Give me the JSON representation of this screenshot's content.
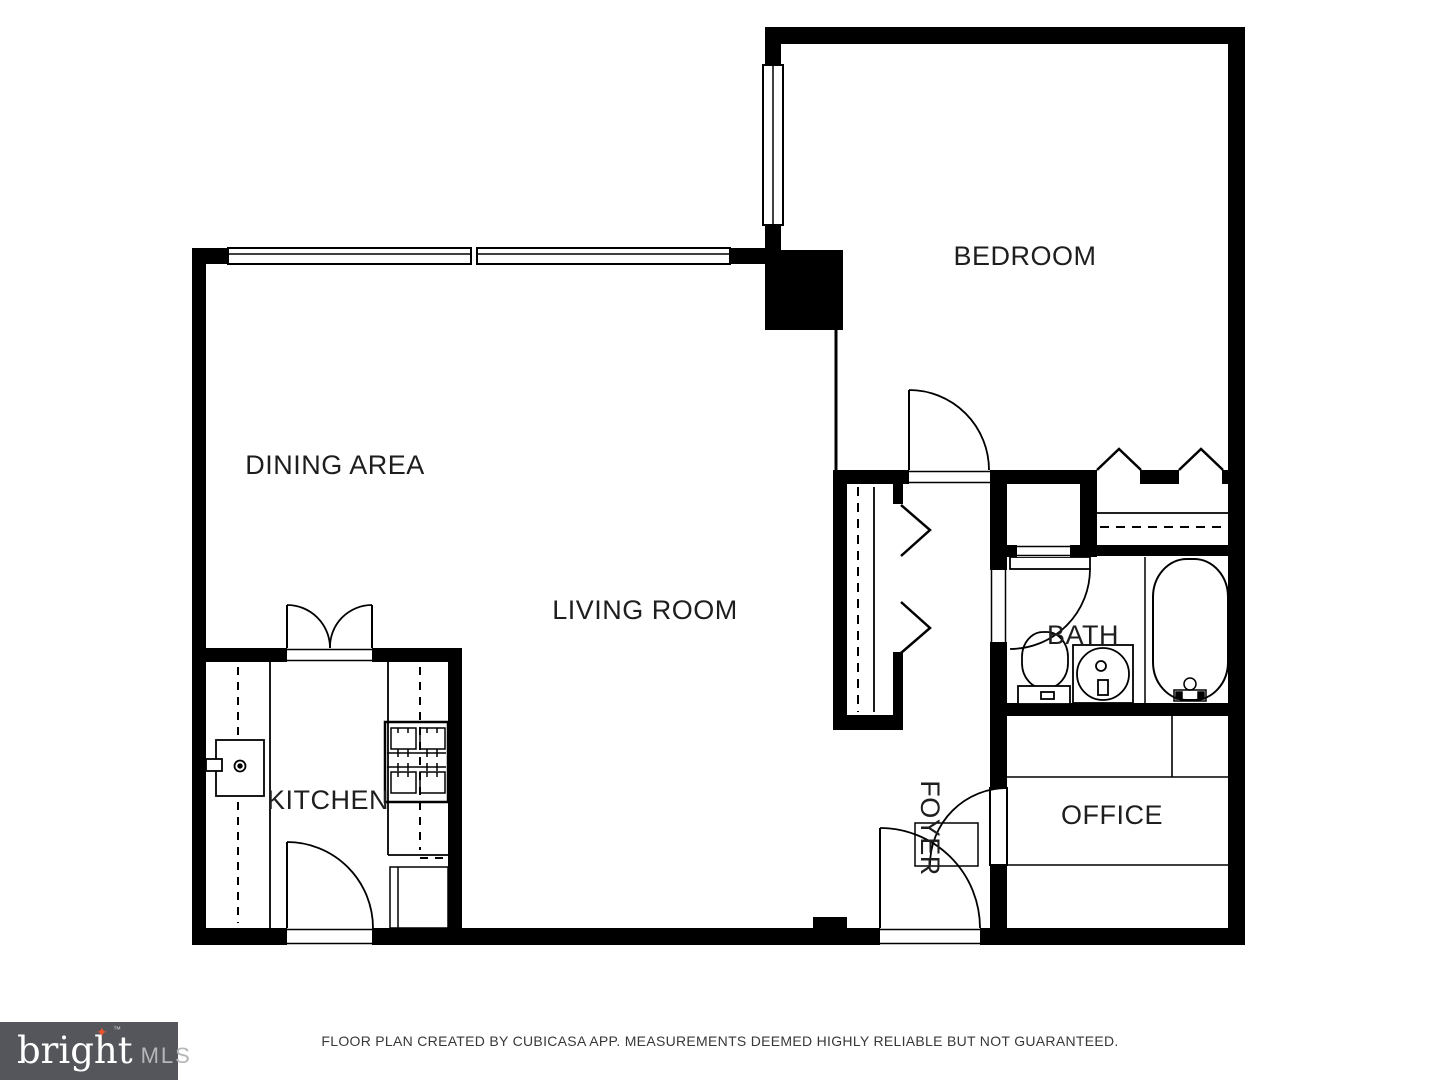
{
  "floor_plan": {
    "rooms": {
      "bedroom": "BEDROOM",
      "dining": "DINING AREA",
      "living": "LIVING ROOM",
      "kitchen": "KITCHEN",
      "bath": "BATH",
      "office": "OFFICE",
      "foyer": "FOYER"
    },
    "colors": {
      "wall": "#000000",
      "label": "#1e1e1e",
      "background": "#ffffff"
    }
  },
  "footer": {
    "disclaimer": "FLOOR PLAN CREATED BY CUBICASA APP. MEASUREMENTS DEEMED HIGHLY RELIABLE BUT NOT GUARANTEED."
  },
  "logo": {
    "brand": "bright",
    "suffix": "MLS",
    "trademark": "™",
    "star_glyph": "✦",
    "colors": {
      "background": "#55565B",
      "brand": "#FFFFFF",
      "suffix": "#B5B6B9",
      "star": "#E8542F"
    }
  }
}
